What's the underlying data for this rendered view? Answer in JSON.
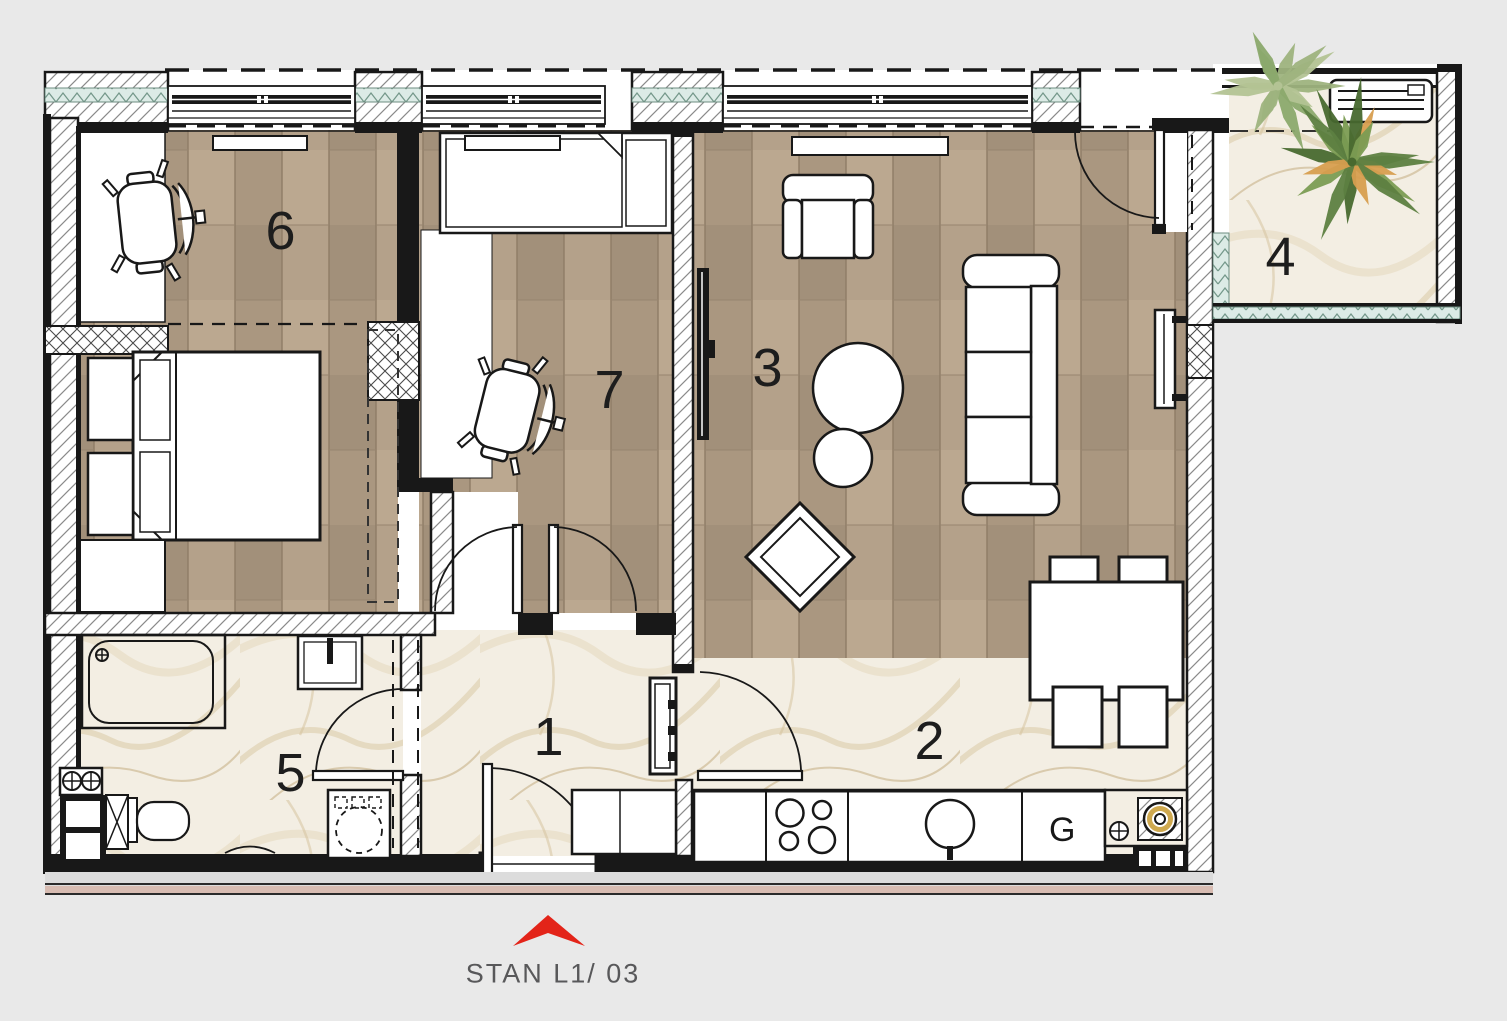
{
  "plan": {
    "label": "STAN L1/ 03"
  },
  "rooms": [
    {
      "number": "1"
    },
    {
      "number": "2"
    },
    {
      "number": "3"
    },
    {
      "number": "4"
    },
    {
      "number": "5"
    },
    {
      "number": "6"
    },
    {
      "number": "7"
    }
  ],
  "kitchen": {
    "fridge_symbol": "G"
  },
  "colors": {
    "accent": "#e32419",
    "labelText": "#58585a",
    "wood": "#b3a08a",
    "marble": "#f3eee3",
    "wall": "#181818",
    "insulation": "#dcebe6"
  }
}
